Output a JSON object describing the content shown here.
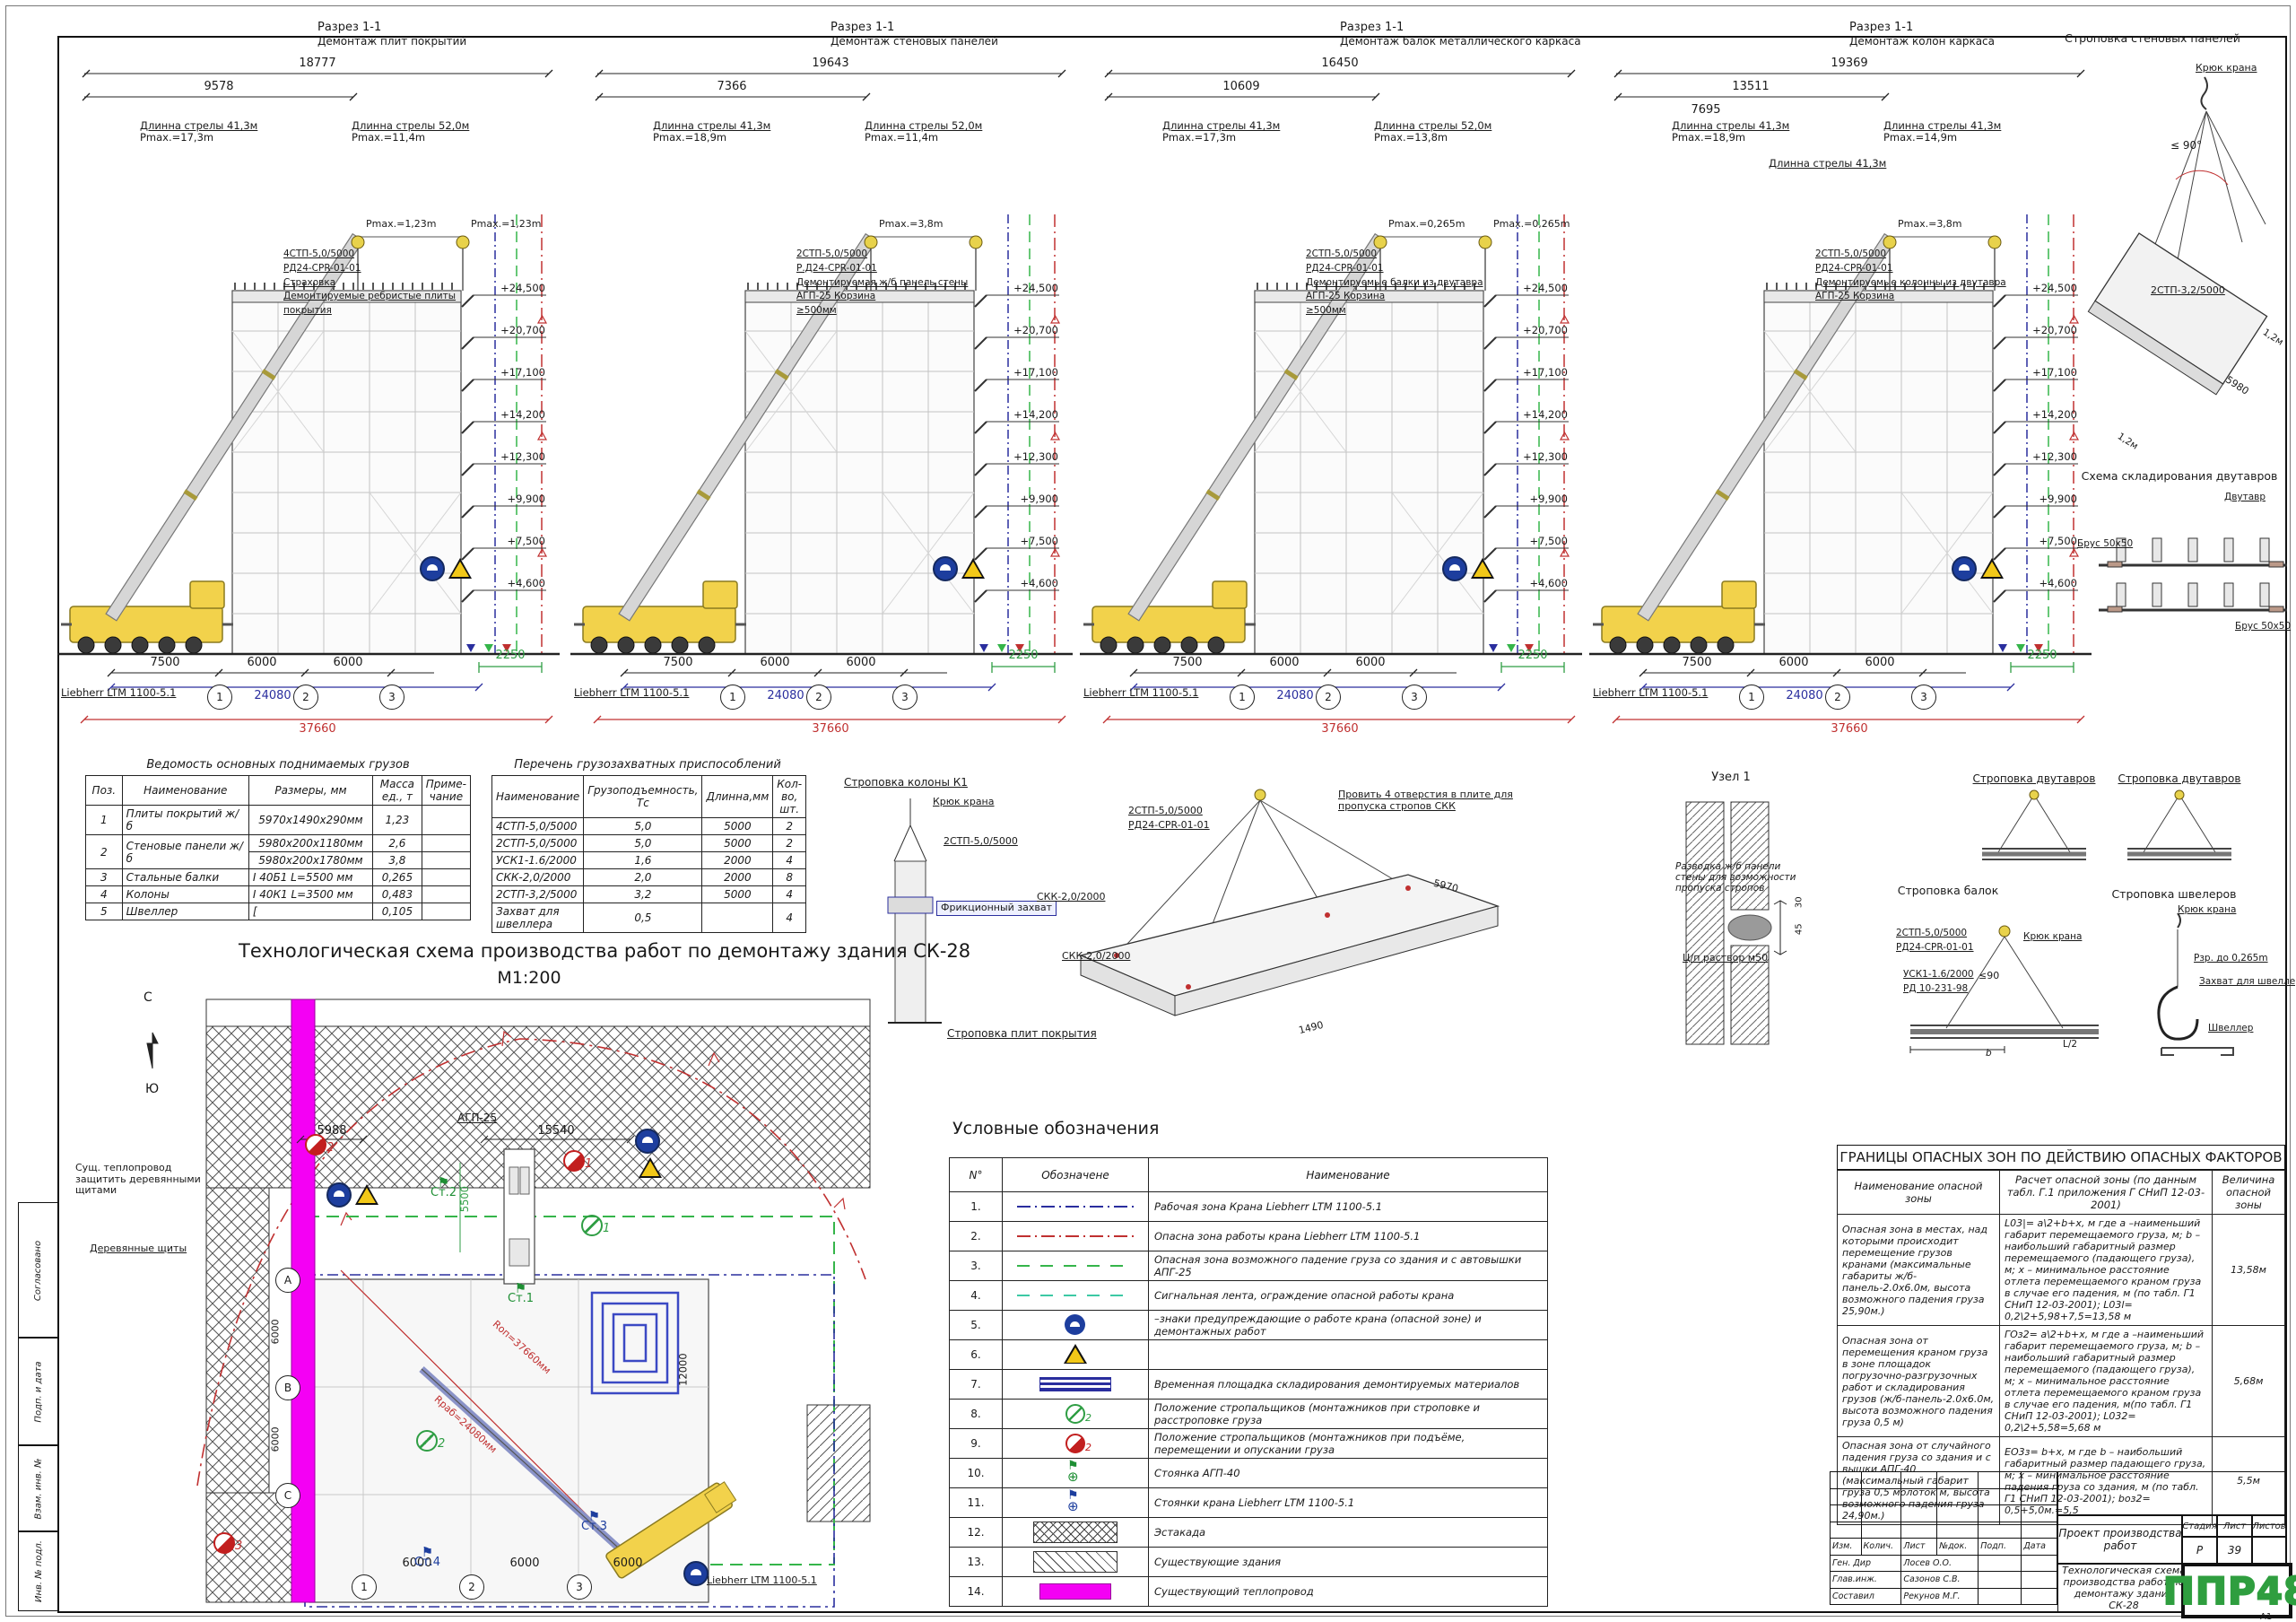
{
  "frame": {
    "format": "А1",
    "side_labels": [
      "Согласовано",
      "Подп. и дата",
      "Взам. инв. №",
      "Инв. № подл."
    ]
  },
  "shared": {
    "elev": [
      "+24,500",
      "+20,700",
      "+17,100",
      "+14,200",
      "+12,300",
      "+9,900",
      "+7,500",
      "+4,600"
    ],
    "bottom": {
      "dims": [
        "7500",
        "6000",
        "6000"
      ],
      "axes": [
        "1",
        "2",
        "3"
      ],
      "total_blue": "24080",
      "total_red": "37660",
      "offset_green": "2250",
      "crane": "Liebherr LTM 1100-5.1"
    }
  },
  "sections": [
    {
      "t1": "Разрез 1-1",
      "t2": "Демонтаж плит покрытий",
      "d1": "18777",
      "d2": "9578",
      "d3": "",
      "b1l": "Длинна стрелы 41,3м",
      "b1p": "Pmax.=17,3m",
      "b2l": "Длинна стрелы 52,0м",
      "b2p": "Pmax.=11,4m",
      "b3l": "",
      "b3p": "",
      "h1": "Pmax.=1,23m",
      "h2": "Pmax.=1,23m",
      "c1": "4СТП-5,0/5000",
      "c2": "РД24-CPR-01-01",
      "c3": "Страховка",
      "c4": "Демонтируемые ребристые плиты покрытия",
      "c5": ""
    },
    {
      "t1": "Разрез 1-1",
      "t2": "Демонтаж стеновых панелей",
      "d1": "19643",
      "d2": "7366",
      "d3": "",
      "b1l": "Длинна стрелы 41,3м",
      "b1p": "Pmax.=18,9m",
      "b2l": "Длинна стрелы 52,0м",
      "b2p": "Pmax.=11,4m",
      "b3l": "",
      "b3p": "",
      "h1": "Pmax.=3,8m",
      "h2": "",
      "c1": "2СТП-5,0/5000",
      "c2": "Р.Д24-CPR-01-01",
      "c3": "Демонтируемая ж/б панель стены",
      "c4": "АГП-25 Корзина",
      "c5": "≥500мм"
    },
    {
      "t1": "Разрез 1-1",
      "t2": "Демонтаж балок металлического каркаса",
      "d1": "16450",
      "d2": "10609",
      "d3": "",
      "b1l": "Длинна стрелы 41,3м",
      "b1p": "Pmax.=17,3m",
      "b2l": "Длинна стрелы 52,0м",
      "b2p": "Pmax.=13,8m",
      "b3l": "",
      "b3p": "",
      "h1": "Pmax.=0,265m",
      "h2": "Pmax.=0,265m",
      "c1": "2СТП-5,0/5000",
      "c2": "РД24-CPR-01-01",
      "c3": "Демонтируемые балки из двутавра",
      "c4": "АГП-25 Корзина",
      "c5": "≥500мм"
    },
    {
      "t1": "Разрез 1-1",
      "t2": "Демонтаж колон каркаса",
      "d1": "19369",
      "d2": "13511",
      "d3": "7695",
      "b1l": "Длинна стрелы 41,3м",
      "b1p": "Pmax.=18,9m",
      "b2l": "Длинна стрелы 41,3м",
      "b2p": "Pmax.=14,9m",
      "b3l": "Длинна стрелы 41,3м",
      "b3p": "",
      "h1": "Pmax.=3,8m",
      "h2": "",
      "c1": "2СТП-5,0/5000",
      "c2": "РД24-CPR-01-01",
      "c3": "Демонтируемые колонны из двутавра",
      "c4": "АГП-25 Корзина",
      "c5": ""
    }
  ],
  "tables": {
    "loads": {
      "title": "Ведомость основных поднимаемых грузов",
      "h": [
        "Поз.",
        "Наименование",
        "Размеры, мм",
        "Масса ед., т",
        "Приме-чание"
      ],
      "r0": {
        "p": "1",
        "n": "Плиты покрытий ж/б",
        "s": "5970х1490х290мм",
        "m": "1,23"
      },
      "r1": {
        "p": "2",
        "n": "Стеновые панели ж/б",
        "s": "5980х200х1180мм",
        "m": "2,6"
      },
      "r2": {
        "s": "5980х200х1780мм",
        "m": "3,8"
      },
      "r3": {
        "p": "3",
        "n": "Стальные балки",
        "s": "Ⅰ 40Б1   L=5500 мм",
        "m": "0,265"
      },
      "r4": {
        "p": "4",
        "n": "Колоны",
        "s": "Ⅰ 40К1   L=3500 мм",
        "m": "0,483"
      },
      "r5": {
        "p": "5",
        "n": "Швеллер",
        "s": "[",
        "m": "0,105"
      }
    },
    "rigging": {
      "title": "Перечень грузозахватных приспособлений",
      "h": [
        "Наименование",
        "Грузоподъемность, Тс",
        "Длинна,мм",
        "Кол-во, шт."
      ],
      "rows": [
        {
          "n": "4СТП-5,0/5000",
          "c": "5,0",
          "l": "5000",
          "q": "2"
        },
        {
          "n": "2СТП-5,0/5000",
          "c": "5,0",
          "l": "5000",
          "q": "2"
        },
        {
          "n": "УСК1-1.6/2000",
          "c": "1,6",
          "l": "2000",
          "q": "4"
        },
        {
          "n": "СКК-2,0/2000",
          "c": "2,0",
          "l": "2000",
          "q": "8"
        },
        {
          "n": "2СТП-3,2/5000",
          "c": "3,2",
          "l": "5000",
          "q": "4"
        },
        {
          "n": "Захват для швеллера",
          "c": "0,5",
          "l": "",
          "q": "4"
        }
      ]
    }
  },
  "plan": {
    "title": "Технологическая схема производства работ по демонтажу здания СК-28",
    "scale": "М1:200",
    "compass_n": "С",
    "compass_s": "Ю",
    "note1": "Сущ. теплопровод защитить деревянными щитами",
    "note2": "Деревянные щиты",
    "agp": "АГП-25",
    "crane": "Liebherr LTM 1100-5.1",
    "r1": "Rоп=37660мм",
    "r2": "Rраб=24080мм",
    "dims": {
      "top1": "5988",
      "top2": "15540",
      "v1": "5500",
      "v2": "12000",
      "b1": "6000",
      "b2": "6000",
      "b3": "6000",
      "l1": "6000",
      "l2": "6000"
    },
    "axesL": [
      "А",
      "В",
      "С"
    ],
    "axesB": [
      "1",
      "2",
      "3"
    ],
    "stands": [
      "Ст.1",
      "Ст.2",
      "Ст.3",
      "Ст.4"
    ],
    "posR": [
      "1",
      "2",
      "3"
    ],
    "posG": [
      "1",
      "2"
    ]
  },
  "details": {
    "d_panel": {
      "title": "Строповка стеновых панелей",
      "hook": "Крюк крана",
      "angle": "≤ 90°",
      "sling": "2СТП-3,2/5000",
      "len": "5980",
      "m1": "1,2м",
      "m2": "1,2м"
    },
    "d_stack": {
      "title": "Схема складирования двутавров",
      "beam": "Двутавр",
      "bar1": "Брус 50х50",
      "bar2": "Брус 50х50"
    },
    "d_tw1": {
      "title": "Строповка двутавров"
    },
    "d_tw2": {
      "title": "Строповка двутавров"
    },
    "d_beam": {
      "title": "Строповка балок",
      "l1": "2СТП-5,0/5000",
      "l2": "РД24-CPR-01-01",
      "l3": "УСК1-1.6/2000",
      "l4": "РД 10-231-98",
      "hook": "Крюк крана",
      "angle": "≤90",
      "half": "L/2",
      "b": "b"
    },
    "d_chan": {
      "title": "Строповка швелеров",
      "hook": "Крюк крана",
      "l1": "Рзр. до 0,265m",
      "l2": "Захват для швеллера",
      "l3": "Швеллер"
    },
    "d_col": {
      "title": "Строповка колоны К1",
      "hook": "Крюк крана",
      "l1": "2СТП-5,0/5000",
      "l2": "Фрикционный захват"
    },
    "d_slab": {
      "title": "Строповка плит покрытия",
      "l1": "2СТП-5,0/5000",
      "l2": "РД24-CPR-01-01",
      "l3": "СКК-2,0/2000",
      "l4": "СКК-2,0/2000",
      "note": "Провить 4 отверстия в плите для пропуска стропов СКК",
      "len": "5970",
      "wid": "1490"
    },
    "d_node": {
      "title": "Узел 1",
      "n1": "Разводка ж/б панели стены для возможности пропуска стропов",
      "n2": "Ц/п раствор м50",
      "d1": "30",
      "d2": "45"
    }
  },
  "legend": {
    "title": "Условные обозначения",
    "headers": [
      "N°",
      "Обозначене",
      "Наименование"
    ],
    "rows": [
      {
        "num": "1.",
        "sym": "line-blue",
        "name": "Рабочая зона Крана Liebherr LTM 1100-5.1"
      },
      {
        "num": "2.",
        "sym": "line-red",
        "name": "Опасна зона работы крана  Liebherr LTM 1100-5.1"
      },
      {
        "num": "3.",
        "sym": "dash-green",
        "name": "Опасная зона возможного падение груза со здания и с автовышки АПГ-25"
      },
      {
        "num": "4.",
        "sym": "dash-teal",
        "name": "Сигнальная лента, ограждение опасной работы крана"
      },
      {
        "num": "5.",
        "sym": "sign-crane",
        "name": "–знаки предупреждающие о работе крана (опасной зоне) и демонтажных работ"
      },
      {
        "num": "6.",
        "sym": "sign-warn",
        "name": ""
      },
      {
        "num": "7.",
        "sym": "pad-blue",
        "name": "Временная площадка складирования демонтируемых материалов"
      },
      {
        "num": "8.",
        "sym": "pos-green",
        "name": "Положение стропальщиков (монтажников  при   строповке и расстроповке груза"
      },
      {
        "num": "9.",
        "sym": "pos-red",
        "name": "Положение стропальщиков (монтажников  при подъёме, перемещении и опускании груза"
      },
      {
        "num": "10.",
        "sym": "stand-green",
        "name": "Стоянка  АГП-40"
      },
      {
        "num": "11.",
        "sym": "stand-blue",
        "name": "Стоянки крана Liebherr LTM 1100-5.1"
      },
      {
        "num": "12.",
        "sym": "hatch-cross",
        "name": "Эстакада"
      },
      {
        "num": "13.",
        "sym": "hatch-diag",
        "name": "Существующие здания"
      },
      {
        "num": "14.",
        "sym": "pipe-mag",
        "name": "Существующий теплопровод"
      }
    ]
  },
  "danger": {
    "title": "ГРАНИЦЫ ОПАСНЫХ ЗОН ПО ДЕЙСТВИЮ ОПАСНЫХ ФАКТОРОВ",
    "headers": [
      "Наименование опасной зоны",
      "Расчет опасной зоны (по данным табл. Г.1 приложения Г СНиП 12-03-2001)",
      "Величина опасной зоны"
    ],
    "rows": [
      {
        "name": "Опасная зона в местах, над которыми происходит перемещение грузов кранами (максимальные габариты ж/б-панель-2.0х6.0м, высота возможного падения груза 25,90м.)",
        "calc": "L03|= a\\2+b+x, м  где a –наименьший габарит перемещаемого груза, м; b – наибольший габаритный размер перемещаемого (падающего груза), м; x – минимальное расстояние отлета перемещаемого краном груза в случае его падения, м (по табл. Г1 СНиП 12-03-2001); L03l= 0,2\\2+5,98+7,5=13,58 м",
        "value": "13,58м"
      },
      {
        "name": "Опасная зона от перемещения краном груза в зоне площадок погрузочно-разгрузочных работ и складирования грузов (ж/б-панель-2.0х6.0м, высота возможного падения груза 0,5 м)",
        "calc": "ГОз2= a\\2+b+x, м  где a –наименьший габарит перемещаемого груза, м; b – наибольший габаритный размер перемещаемого (падающего груза), м; x – минимальное расстояние отлета перемещаемого краном груза в случае его падения, м(по табл. Г1 СНиП 12-03-2001); L032= 0,2\\2+5,58=5,68 м",
        "value": "5,68м"
      },
      {
        "name": "Опасная зона от случайного падения груза со здания и с вышки АПГ-40 (максимальный габарит груза 0,5 молоток м, высота возможного падения груза 24,90м.)",
        "calc": "ЕО3з= b+x, м  где b – наибольший габаритный размер падающего груза, м; x – минимальное расстояние падения груза со здания, м (по табл. Г1 СНиП 12-03-2001); bоз2= 0,5+5,0м.=5,5",
        "value": "5,5м"
      }
    ]
  },
  "titleblock": {
    "cols": [
      "Изм.",
      "Колич.",
      "Лист",
      "№док.",
      "Подп.",
      "Дата"
    ],
    "roles": [
      {
        "r": "Ген. Дир",
        "n": "Лосев О.О."
      },
      {
        "r": "Глав.инж.",
        "n": "Сазонов С.В."
      },
      {
        "r": "Составил",
        "n": "Рекунов М.Г."
      }
    ],
    "project": "Проект производства работ",
    "stage_h": [
      "Стадия",
      "Лист",
      "Листов"
    ],
    "stage_v": [
      "Р",
      "39",
      ""
    ],
    "doc_title": "Технологическая схема производства работ по демонтажу здания СК-28",
    "logo": "ППР48"
  }
}
